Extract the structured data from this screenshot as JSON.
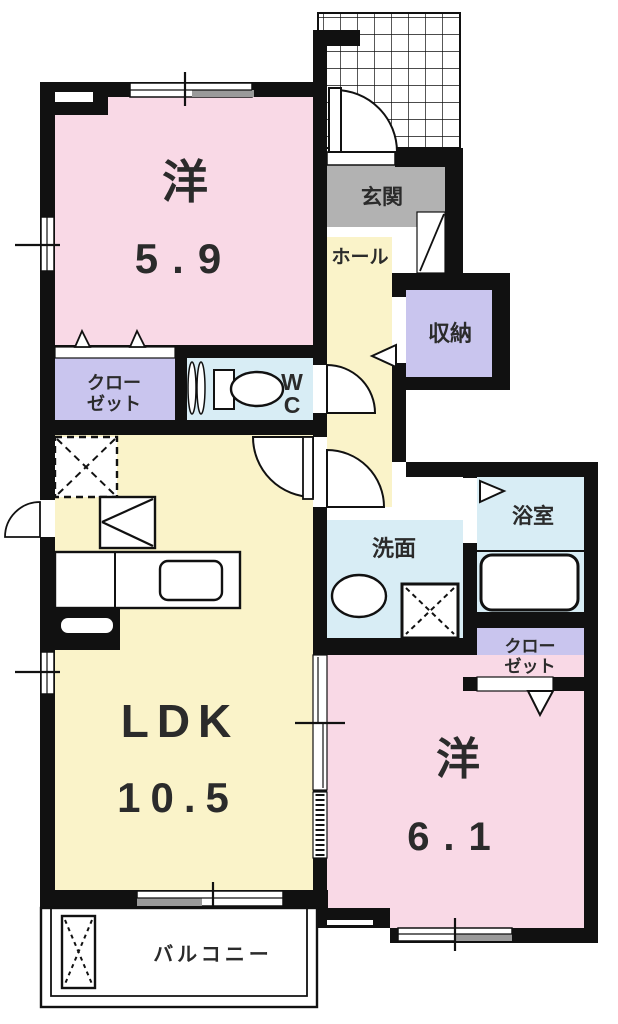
{
  "floorplan": {
    "rooms": {
      "bedroom_top": {
        "name": "洋",
        "area": "5.9"
      },
      "entrance": {
        "name": "玄関"
      },
      "hall": {
        "name": "ホール"
      },
      "storage": {
        "name": "収納"
      },
      "closet_left": {
        "line1": "クロー",
        "line2": "ゼット"
      },
      "wc": {
        "line1": "W",
        "line2": "C"
      },
      "washroom": {
        "name": "洗面"
      },
      "bathroom": {
        "name": "浴室"
      },
      "closet_right": {
        "line1": "クロー",
        "line2": "ゼット"
      },
      "ldk": {
        "name": "LDK",
        "area": "10.5"
      },
      "bedroom_bottom": {
        "name": "洋",
        "area": "6.1"
      },
      "balcony": {
        "name": "バルコニー"
      }
    },
    "colors": {
      "room_pink": "#f9d9e6",
      "room_yellow": "#faf3c9",
      "room_blue": "#d8edf5",
      "room_purple": "#c9c5ee",
      "entrance_gray": "#b2b2b2",
      "wall_black": "#111111",
      "window_gray": "#9a9a9a"
    }
  }
}
